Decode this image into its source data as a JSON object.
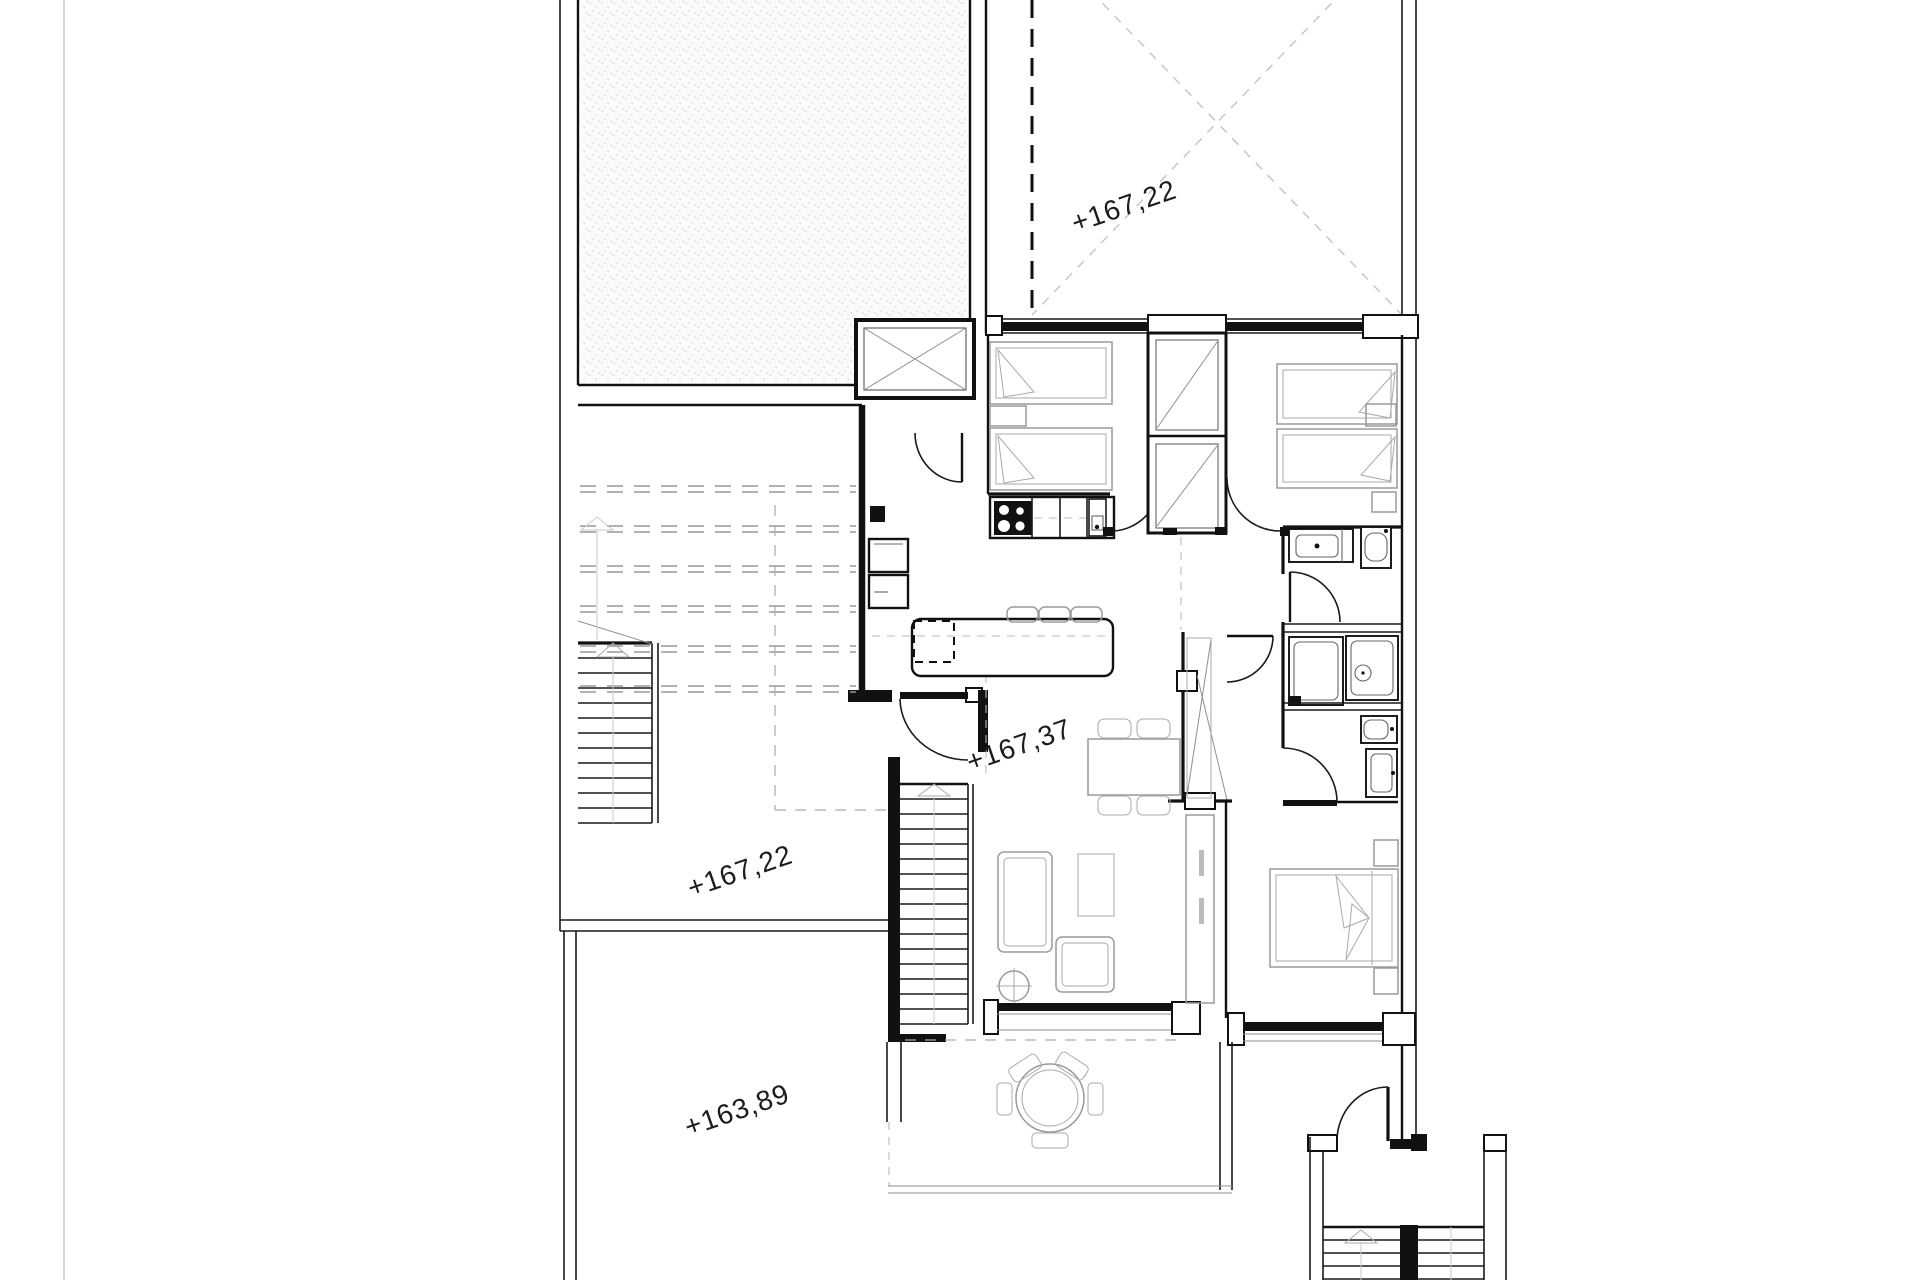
{
  "page": {
    "background": "#ffffff",
    "edge_line_color": "#cccccc"
  },
  "plan": {
    "elevation_labels": [
      {
        "area": "roof-terrace",
        "text": "+167,22"
      },
      {
        "area": "living-room",
        "text": "+167,37"
      },
      {
        "area": "courtyard",
        "text": "+167,22"
      },
      {
        "area": "lower-terrace",
        "text": "+163,89"
      }
    ],
    "colors": {
      "wall": "#111111",
      "furniture_outline": "#9a9a9a",
      "dashed_guides": "#aaaaaa",
      "terrace_cross": "#c4c4c4",
      "stipple_dot": "#d8d8d8"
    }
  }
}
